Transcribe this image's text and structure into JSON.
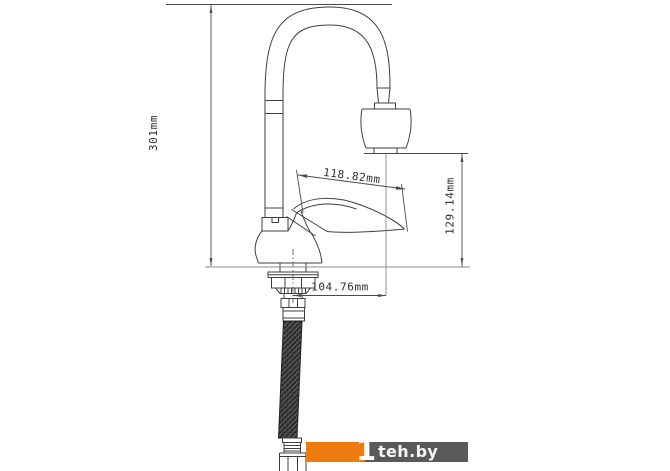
{
  "diagram": {
    "dimension_labels": {
      "total_height": "301mm",
      "handle_length": "118.82mm",
      "outlet_height": "129.14mm",
      "spout_offset": "104.76mm"
    }
  },
  "watermark": {
    "mark": "1",
    "site": "teh.by"
  },
  "colors": {
    "outline": "#3f3f3f",
    "dimension_line": "#4a4a4a",
    "reference_line": "#8a8a8a",
    "hose_fill": "#2b2b2b",
    "watermark_orange": "#ee7b10",
    "watermark_gray": "#58595b",
    "background": "#ffffff"
  }
}
